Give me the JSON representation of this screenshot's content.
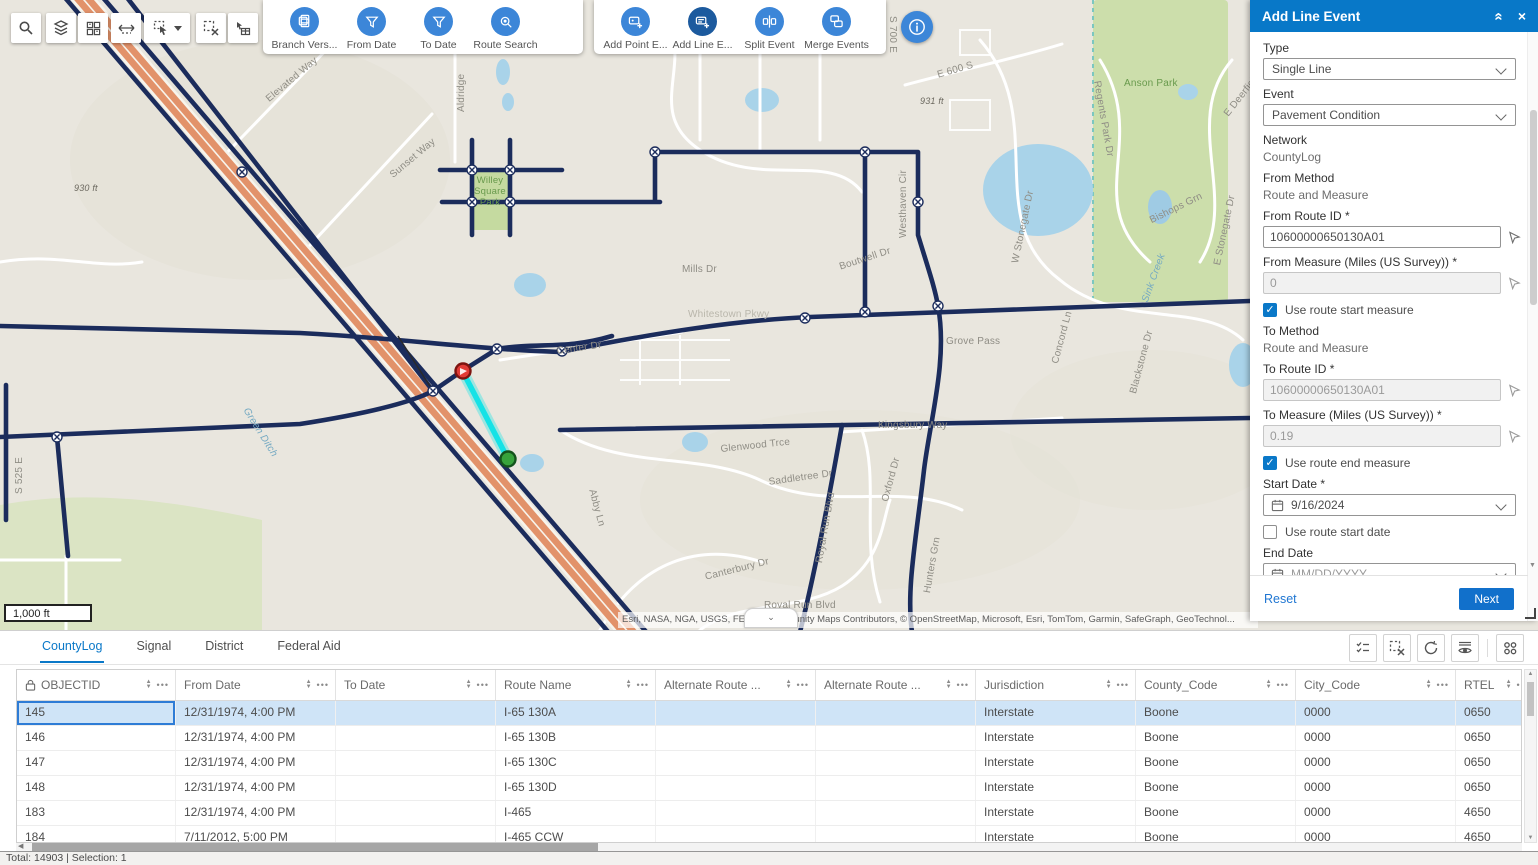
{
  "app": {
    "status": "Total: 14903 | Selection: 1"
  },
  "colors": {
    "accent": "#0079c1",
    "tool_blue": "#3c86d8",
    "tool_selected": "#1c5a9e",
    "selection_cyan": "#15e2e6",
    "marker_start": "#e23b36",
    "marker_end": "#37a33c",
    "selected_row": "#cfe4f7"
  },
  "map": {
    "scale": "1,000 ft",
    "attribution": "Esri, NASA, NGA, USGS, FEMA | Community Maps Contributors, © OpenStreetMap, Microsoft, Esri, TomTom, Garmin, SafeGraph, GeoTechnol...",
    "labels": [
      {
        "t": "Elevated Way",
        "x": 264,
        "y": 96,
        "r": -40
      },
      {
        "t": "Sunset Way",
        "x": 388,
        "y": 172,
        "r": -40
      },
      {
        "t": "930 ft",
        "x": 74,
        "y": 183,
        "c": "e"
      },
      {
        "t": "Anson Park",
        "x": 1124,
        "y": 78,
        "c": "g"
      },
      {
        "t": "Aldridge",
        "x": 456,
        "y": 112,
        "r": -90
      },
      {
        "t": "Willey Square Park",
        "x": 468,
        "y": 176,
        "c": "g wrap"
      },
      {
        "t": "Mills Dr",
        "x": 682,
        "y": 264
      },
      {
        "t": "Center Dr",
        "x": 556,
        "y": 346,
        "r": -8
      },
      {
        "t": "Whitestown Pkwy",
        "x": 688,
        "y": 309,
        "c": "r"
      },
      {
        "t": "Boutwell Dr",
        "x": 838,
        "y": 262,
        "r": -18
      },
      {
        "t": "Westhaven Cir",
        "x": 898,
        "y": 238,
        "r": -90
      },
      {
        "t": "E 600 S",
        "x": 936,
        "y": 70,
        "r": -16
      },
      {
        "t": "931 ft",
        "x": 920,
        "y": 96,
        "c": "e"
      },
      {
        "t": "Regents Park Dr",
        "x": 1102,
        "y": 80,
        "r": 80
      },
      {
        "t": "W Stonegate Dr",
        "x": 1010,
        "y": 262,
        "r": -78
      },
      {
        "t": "Bishops Grn",
        "x": 1148,
        "y": 216,
        "r": -26
      },
      {
        "t": "E Stonegate Dr",
        "x": 1212,
        "y": 264,
        "r": -78
      },
      {
        "t": "E Deerfield Dr",
        "x": 1222,
        "y": 112,
        "r": -52
      },
      {
        "t": "S 700 E",
        "x": 898,
        "y": 16,
        "r": 90
      },
      {
        "t": "Grove Pass",
        "x": 946,
        "y": 336
      },
      {
        "t": "Kingsbury Way",
        "x": 878,
        "y": 420
      },
      {
        "t": "Glenwood Trce",
        "x": 720,
        "y": 444,
        "r": -6
      },
      {
        "t": "Saddletree Dr",
        "x": 768,
        "y": 477,
        "r": -8
      },
      {
        "t": "Abby Ln",
        "x": 597,
        "y": 488,
        "r": 75
      },
      {
        "t": "Royal Run Blvd",
        "x": 814,
        "y": 562,
        "r": -80
      },
      {
        "t": "Oxford Dr",
        "x": 880,
        "y": 500,
        "r": -75
      },
      {
        "t": "Hunters Grn",
        "x": 922,
        "y": 592,
        "r": -80
      },
      {
        "t": "Canterbury Dr",
        "x": 704,
        "y": 572,
        "r": -14
      },
      {
        "t": "Royal Run Blvd",
        "x": 764,
        "y": 600
      },
      {
        "t": "Concord Ln",
        "x": 1050,
        "y": 362,
        "r": -75
      },
      {
        "t": "Blackstone Dr",
        "x": 1128,
        "y": 392,
        "r": -75
      },
      {
        "t": "Sink Creek",
        "x": 1140,
        "y": 300,
        "r": -70,
        "c": "w"
      },
      {
        "t": "Green Ditch",
        "x": 250,
        "y": 406,
        "r": 58,
        "c": "w"
      },
      {
        "t": "S 525 E",
        "x": 14,
        "y": 494,
        "r": -90
      }
    ]
  },
  "toolbar_primary": {
    "items": [
      {
        "label": "Branch Vers..."
      },
      {
        "label": "From Date"
      },
      {
        "label": "To Date"
      },
      {
        "label": "Route Search"
      }
    ]
  },
  "toolbar_events": {
    "items": [
      {
        "label": "Add Point E..."
      },
      {
        "label": "Add Line E...",
        "selected": true
      },
      {
        "label": "Split Event"
      },
      {
        "label": "Merge Events"
      }
    ]
  },
  "panel": {
    "title": "Add Line Event",
    "type_label": "Type",
    "type_value": "Single Line",
    "event_label": "Event",
    "event_value": "Pavement Condition",
    "network_label": "Network",
    "network_value": "CountyLog",
    "from_method_label": "From Method",
    "from_method_value": "Route and Measure",
    "from_route_label": "From Route ID *",
    "from_route_value": "10600000650130A01",
    "from_measure_label": "From Measure (Miles (US Survey)) *",
    "from_measure_value": "0",
    "use_route_start_measure": "Use route start measure",
    "to_method_label": "To Method",
    "to_method_value": "Route and Measure",
    "to_route_label": "To Route ID *",
    "to_route_value": "10600000650130A01",
    "to_measure_label": "To Measure (Miles (US Survey)) *",
    "to_measure_value": "0.19",
    "use_route_end_measure": "Use route end measure",
    "start_date_label": "Start Date *",
    "start_date_value": "9/16/2024",
    "use_route_start_date": "Use route start date",
    "end_date_label": "End Date",
    "end_date_placeholder": "MM/DD/YYYY",
    "use_route_end_date": "Use route end date",
    "reset_label": "Reset",
    "next_label": "Next"
  },
  "table": {
    "tabs": [
      {
        "label": "CountyLog",
        "active": true
      },
      {
        "label": "Signal"
      },
      {
        "label": "District"
      },
      {
        "label": "Federal Aid"
      }
    ],
    "columns": [
      {
        "label": "OBJECTID",
        "locked": true
      },
      {
        "label": "From Date"
      },
      {
        "label": "To Date"
      },
      {
        "label": "Route Name"
      },
      {
        "label": "Alternate Route ..."
      },
      {
        "label": "Alternate Route ..."
      },
      {
        "label": "Jurisdiction"
      },
      {
        "label": "County_Code"
      },
      {
        "label": "City_Code"
      },
      {
        "label": "RTEL"
      }
    ],
    "rows": [
      {
        "selected": true,
        "cells": [
          "145",
          "12/31/1974, 4:00 PM",
          "",
          "I-65 130A",
          "",
          "",
          "Interstate",
          "Boone",
          "0000",
          "0650"
        ]
      },
      {
        "cells": [
          "146",
          "12/31/1974, 4:00 PM",
          "",
          "I-65 130B",
          "",
          "",
          "Interstate",
          "Boone",
          "0000",
          "0650"
        ]
      },
      {
        "cells": [
          "147",
          "12/31/1974, 4:00 PM",
          "",
          "I-65 130C",
          "",
          "",
          "Interstate",
          "Boone",
          "0000",
          "0650"
        ]
      },
      {
        "cells": [
          "148",
          "12/31/1974, 4:00 PM",
          "",
          "I-65 130D",
          "",
          "",
          "Interstate",
          "Boone",
          "0000",
          "0650"
        ]
      },
      {
        "cells": [
          "183",
          "12/31/1974, 4:00 PM",
          "",
          "I-465",
          "",
          "",
          "Interstate",
          "Boone",
          "0000",
          "4650"
        ]
      },
      {
        "cells": [
          "184",
          "7/11/2012, 5:00 PM",
          "",
          "I-465 CCW",
          "",
          "",
          "Interstate",
          "Boone",
          "0000",
          "4650"
        ]
      }
    ]
  }
}
